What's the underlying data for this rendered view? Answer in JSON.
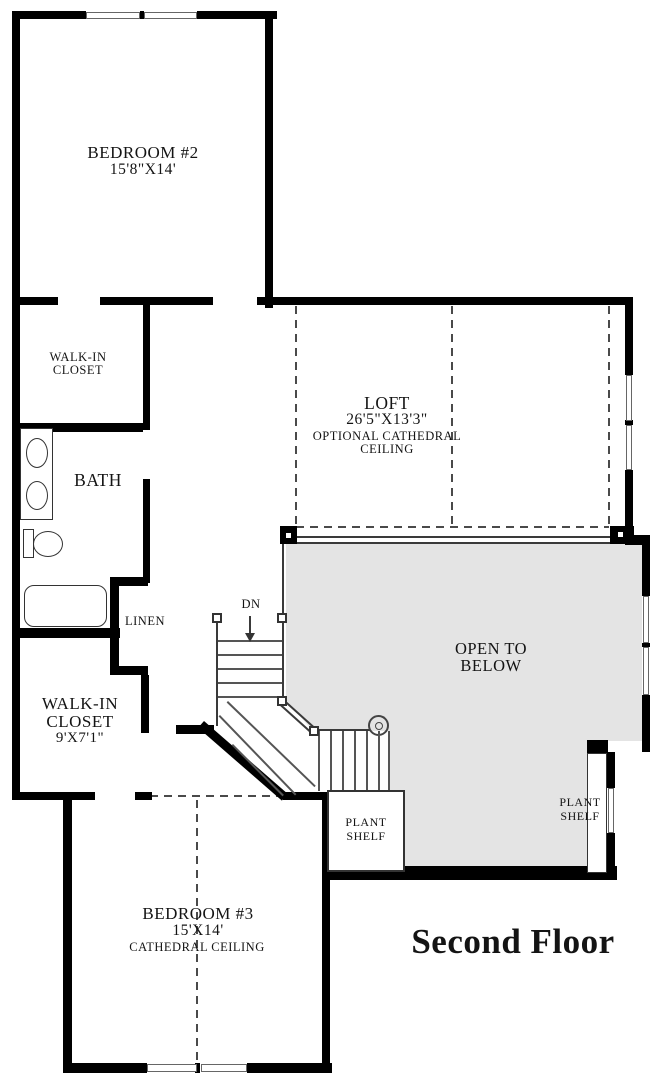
{
  "title": "Second Floor",
  "labels": {
    "bedroom2": {
      "name": "BEDROOM #2",
      "dims": "15'8\"X14'"
    },
    "closet_upper": {
      "line1": "WALK-IN",
      "line2": "CLOSET"
    },
    "bath": {
      "name": "BATH"
    },
    "linen": {
      "name": "LINEN"
    },
    "closet_lower": {
      "line1": "WALK-IN",
      "line2": "CLOSET",
      "dims": "9'X7'1\""
    },
    "loft": {
      "name": "LOFT",
      "dims": "26'5\"X13'3\"",
      "note1": "OPTIONAL CATHEDRAL",
      "note2": "CEILING"
    },
    "open_below": {
      "line1": "OPEN TO",
      "line2": "BELOW"
    },
    "stairs": {
      "down": "DN"
    },
    "plant_shelf": {
      "line1": "PLANT",
      "line2": "SHELF"
    },
    "bedroom3": {
      "name": "BEDROOM #3",
      "dims": "15'X14'",
      "note": "CATHEDRAL CEILING"
    }
  },
  "colors": {
    "wall": "#000000",
    "open_area_fill": "#e4e4e4",
    "line": "#3a3a3a",
    "text": "#141414"
  }
}
